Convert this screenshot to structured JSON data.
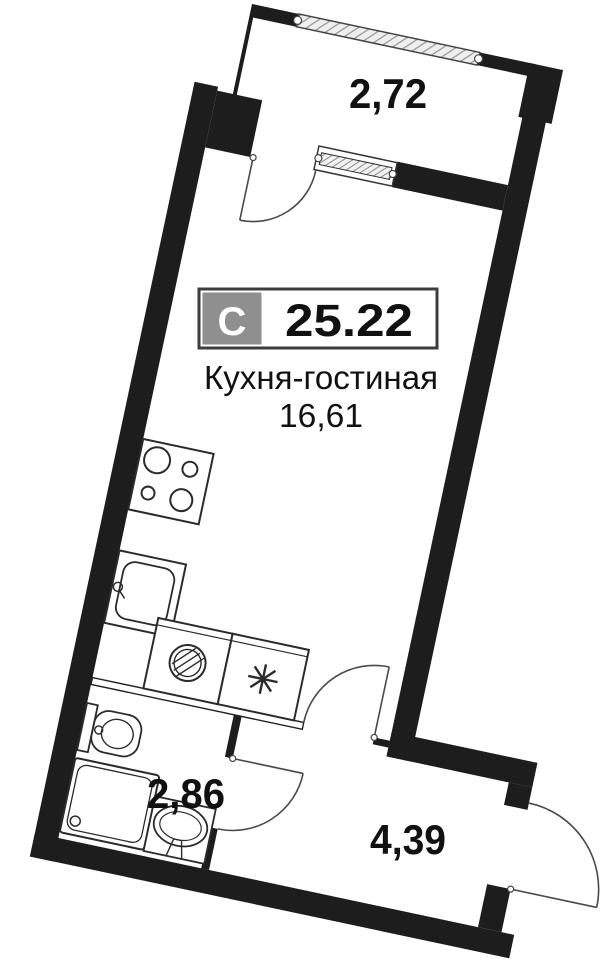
{
  "unit_badge": {
    "type_letter": "С",
    "total_area": "25.22"
  },
  "rooms": {
    "kitchen_living": {
      "name": "Кухня-гостиная",
      "area": "16,61"
    },
    "balcony": {
      "area": "2,72"
    },
    "bathroom": {
      "area": "2,86"
    },
    "hallway": {
      "area": "4,39"
    }
  },
  "fixtures": [
    "stove-icon",
    "kitchen-sink-icon",
    "washing-machine-icon",
    "refrigerator-icon",
    "toilet-icon",
    "shower-tray-icon",
    "washbasin-icon"
  ],
  "colors": {
    "wall": "#1d1d1d",
    "background": "#ffffff",
    "badge_gray": "#8f8f8f",
    "badge_border": "#3d3d3d",
    "fixture_line": "#2b2b2b",
    "door_arc": "#4a4a4a",
    "glazing_hatch": "#9a9a9a"
  },
  "plan_rotation_deg": 12
}
